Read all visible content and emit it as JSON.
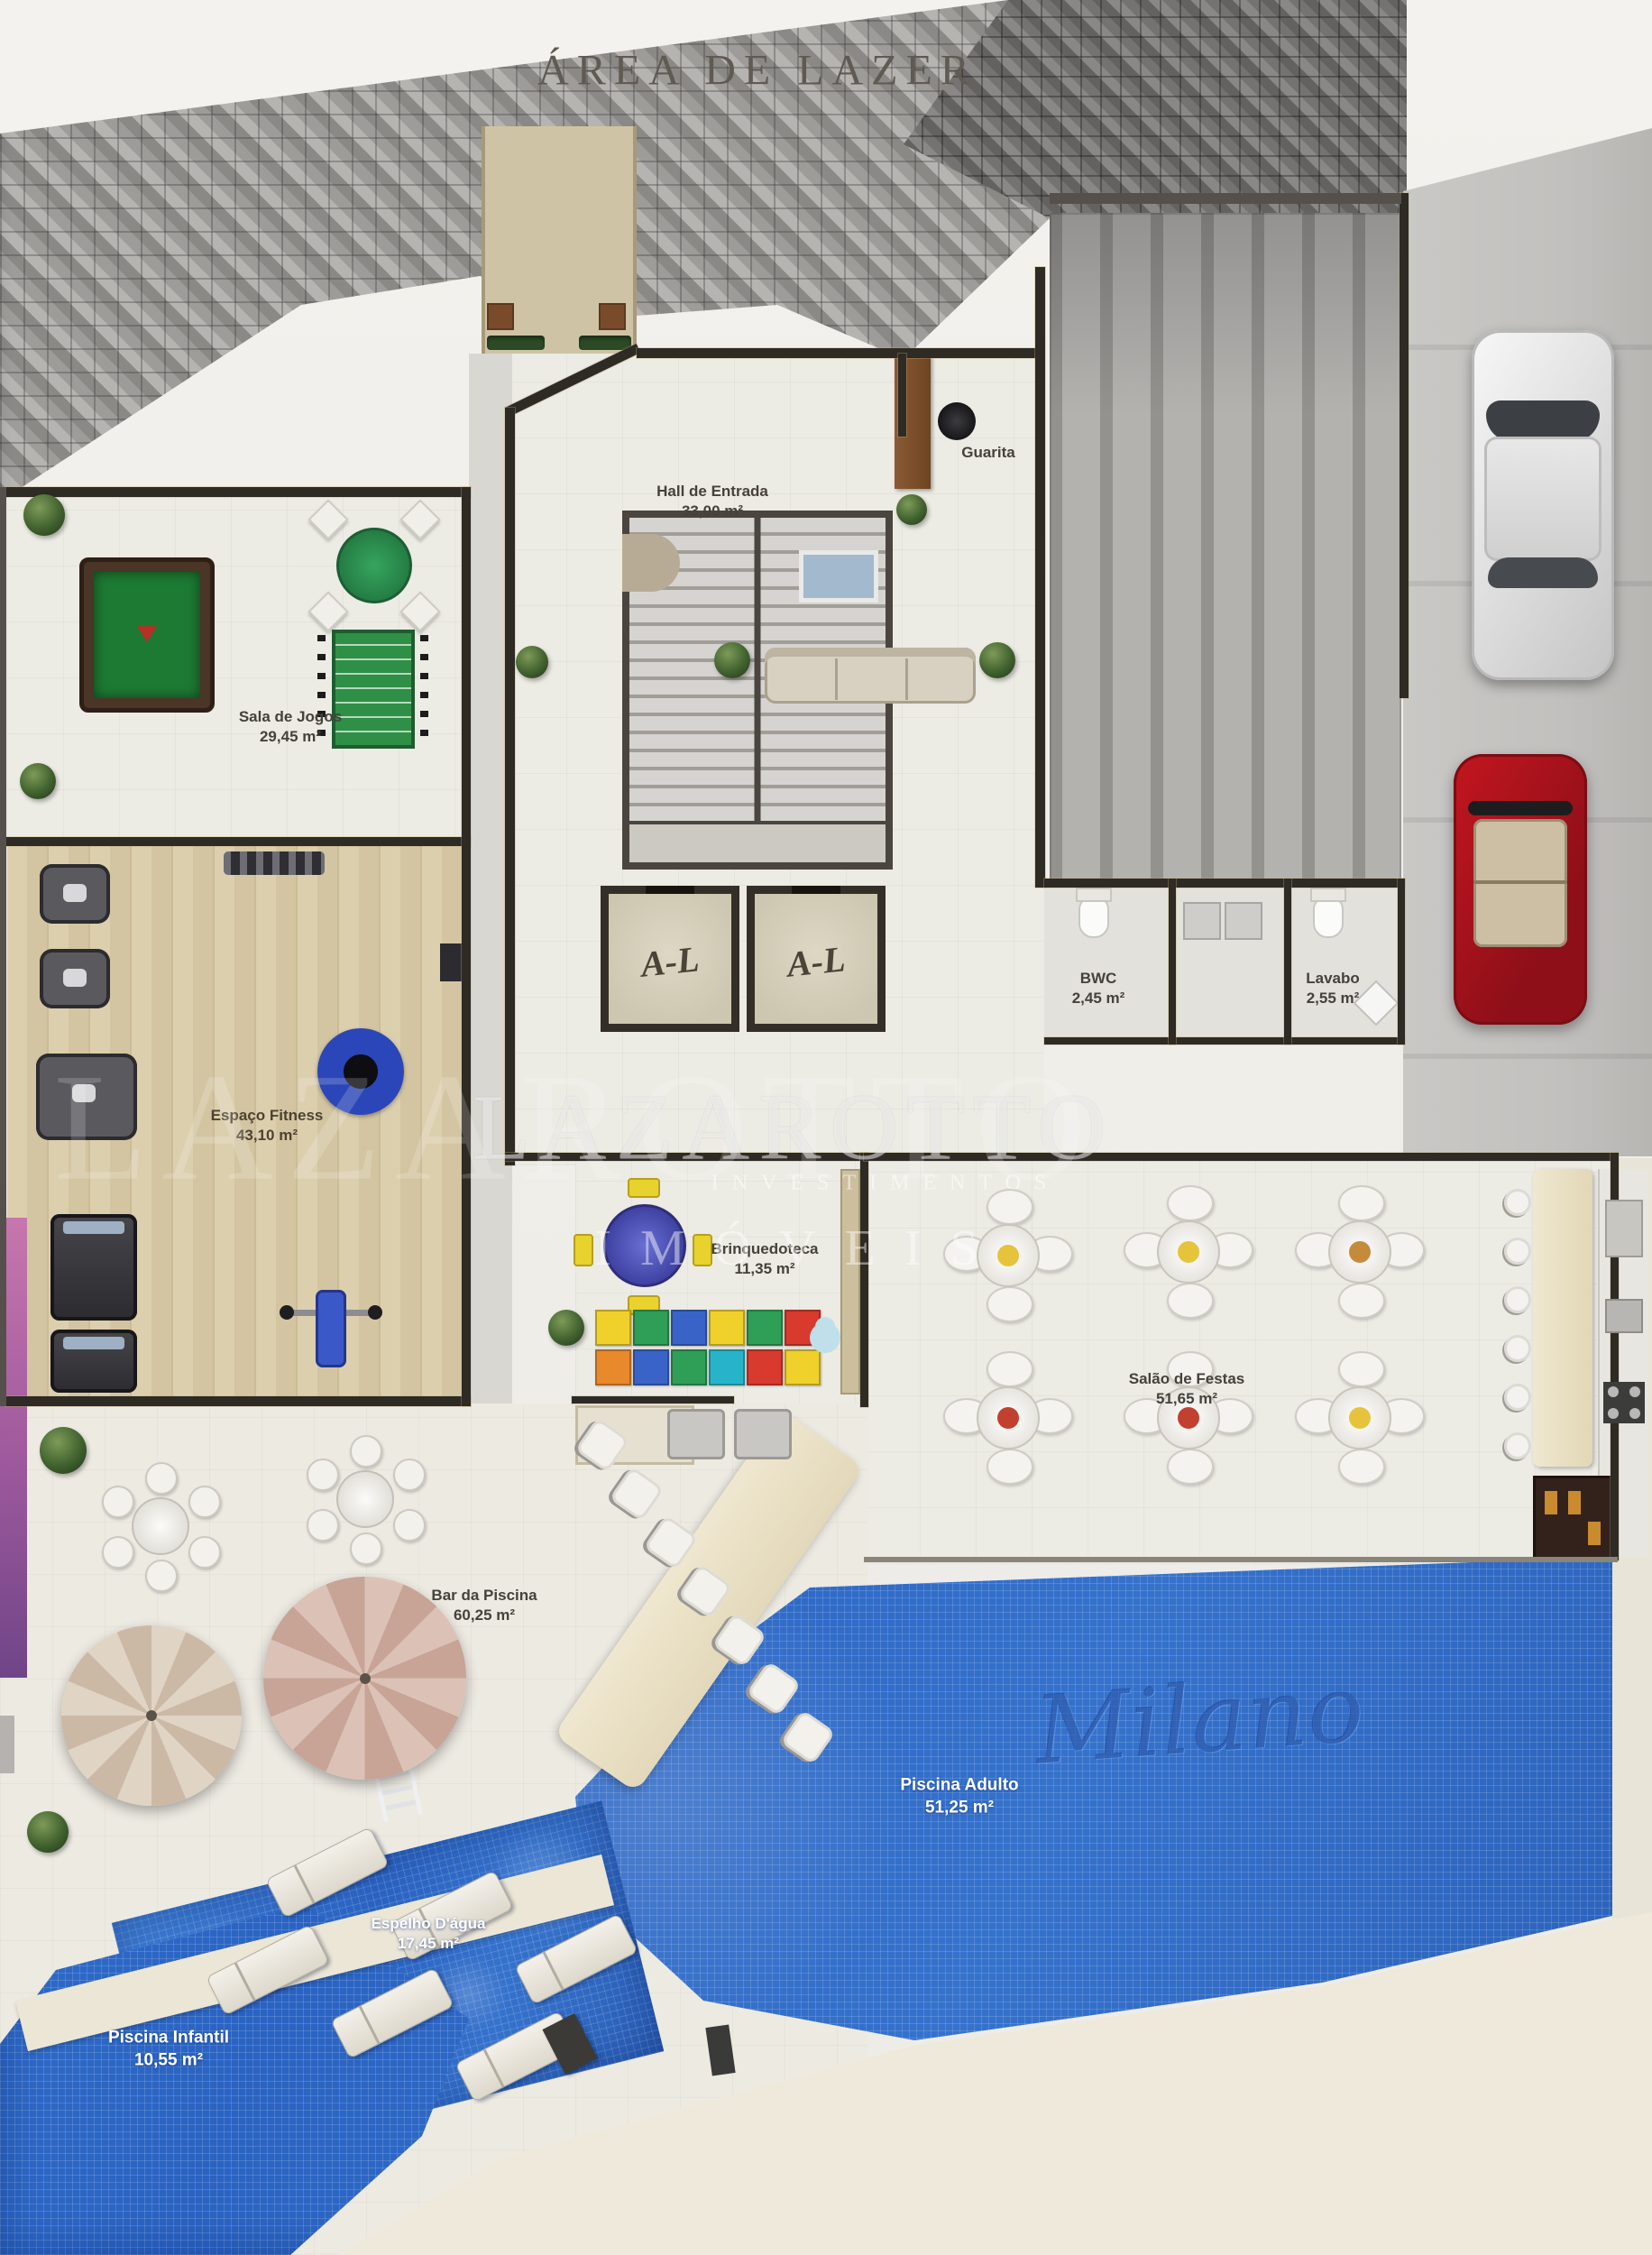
{
  "title": "ÁREA DE LAZER",
  "watermark": {
    "brand": "LAZAROTTO",
    "brand_echo": "LAZAROTTO",
    "line2": "INVESTIMENTOS",
    "line3": "IMÓVEIS"
  },
  "pool_signature": "Milano",
  "elevator_logo": "A-L",
  "rooms": {
    "sala_de_jogos": {
      "label": "Sala de Jogos",
      "area": "29,45 m²"
    },
    "espaco_fitness": {
      "label": "Espaço Fitness",
      "area": "43,10 m²"
    },
    "hall_de_entrada": {
      "label": "Hall de Entrada",
      "area": "33,00 m²"
    },
    "guarita": {
      "label": "Guarita"
    },
    "bwc": {
      "label": "BWC",
      "area": "2,45 m²"
    },
    "lavabo": {
      "label": "Lavabo",
      "area": "2,55 m²"
    },
    "brinquedoteca": {
      "label": "Brinquedoteca",
      "area": "11,35 m²"
    },
    "salao_de_festas": {
      "label": "Salão de Festas",
      "area": "51,65 m²"
    },
    "bar_da_piscina": {
      "label": "Bar da Piscina",
      "area": "60,25 m²"
    },
    "piscina_adulto": {
      "label": "Piscina Adulto",
      "area": "51,25 m²"
    },
    "espelho_dagua": {
      "label": "Espelho D'água",
      "area": "17,45 m²"
    },
    "piscina_infantil": {
      "label": "Piscina Infantil",
      "area": "10,55 m²"
    }
  },
  "colors": {
    "background": "#f1efea",
    "floor_tile": "#ecebe4",
    "wood_floor": "#d6c9a4",
    "wall": "#2e2a24",
    "pool_water": "#2f6cc8",
    "deck": "#ece6d8",
    "paver_gray": "#a7a5a2",
    "parking_gray": "#c7c6c3",
    "accent_purple": "#a85f9e",
    "pool_table_green": "#1d7a33",
    "car_red": "#c3161f",
    "label_text": "#45413b",
    "title_text": "#5f5a52"
  }
}
